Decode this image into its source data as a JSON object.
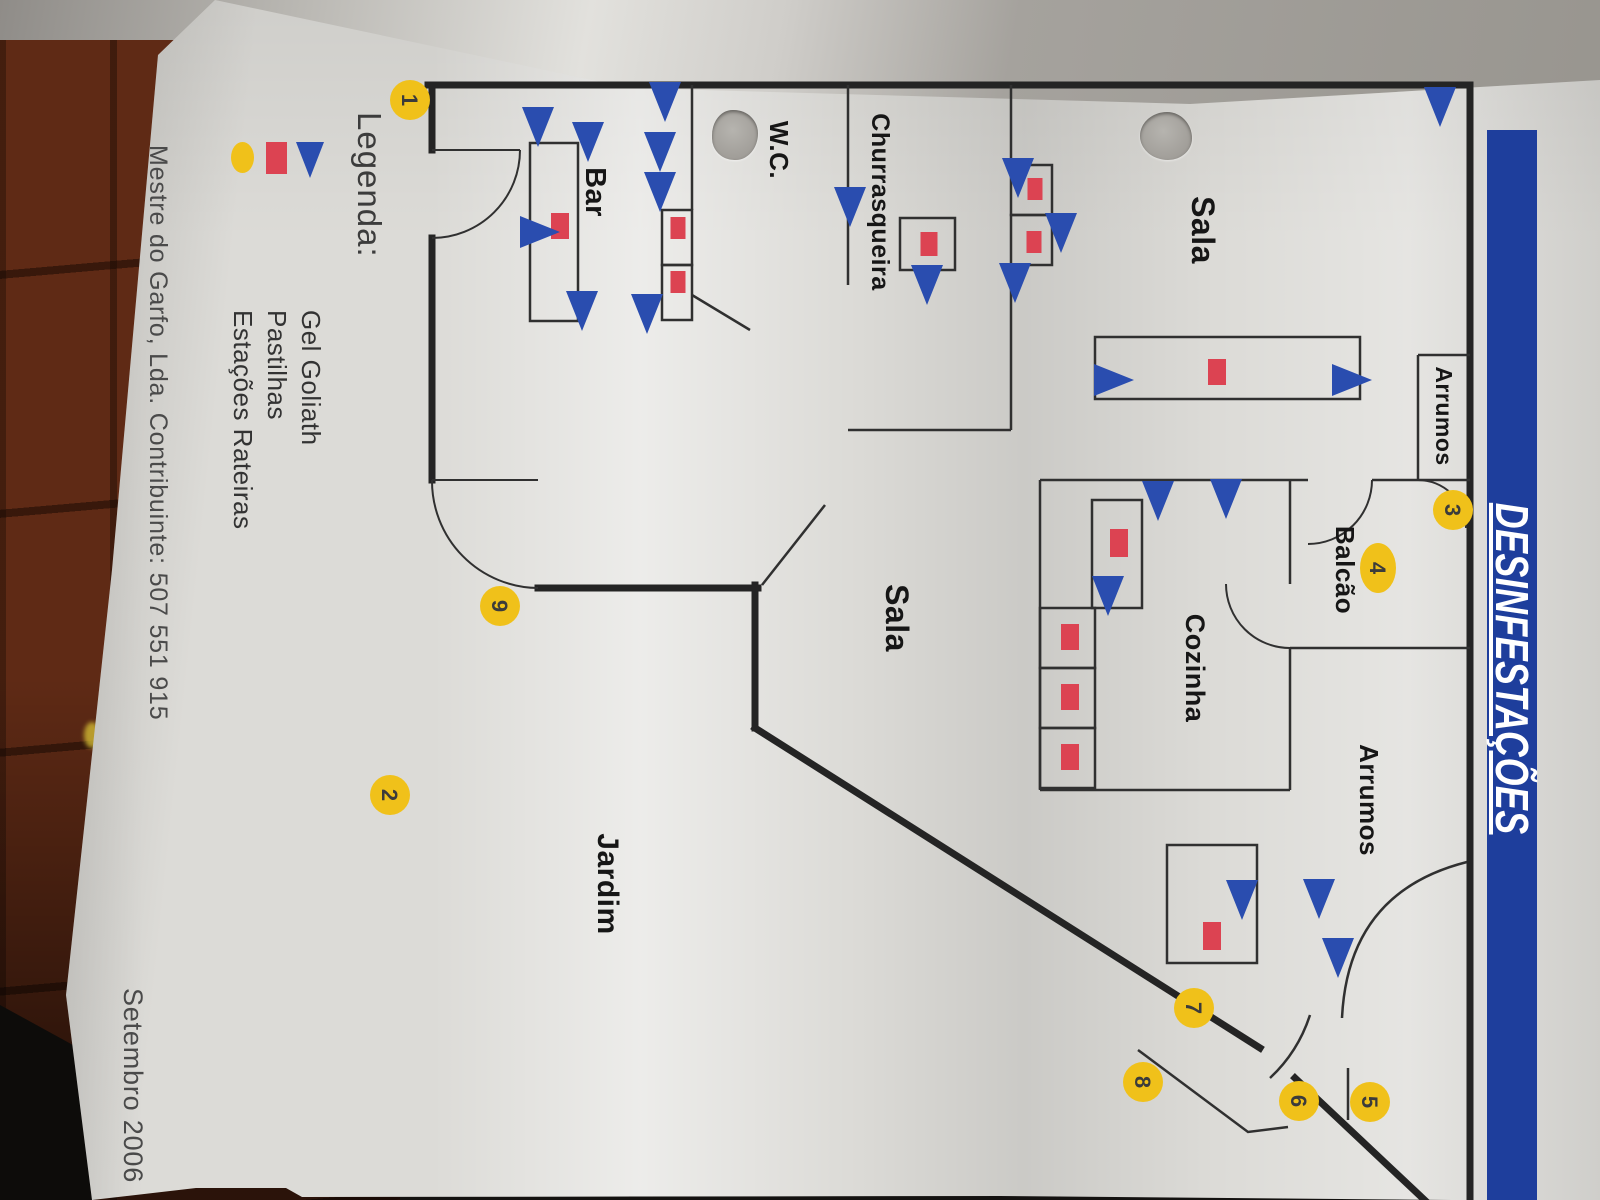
{
  "banner": {
    "title": "DESINFESTAÇÕES"
  },
  "colors": {
    "banner_blue": "#1e3e9c",
    "triangle_blue": "#2a4daf",
    "square_red": "#dc4352",
    "circle_yellow": "#f0c11a",
    "wall_black": "#242424"
  },
  "legend": {
    "heading": "Legenda:",
    "items": [
      {
        "symbol": "triangle-icon",
        "label": "Gel Goliath"
      },
      {
        "symbol": "square-icon",
        "label": "Pastilhas"
      },
      {
        "symbol": "ellipse-icon",
        "label": "Estações Rateiras"
      }
    ]
  },
  "footer": {
    "company": "Mestre do Garfo, Lda. Contribuinte: 507 551 915",
    "date": "Setembro 2006"
  },
  "plan": {
    "rooms": [
      {
        "label": "Sala",
        "x": 230,
        "y": 408,
        "fs": 32
      },
      {
        "label": "Arrumos",
        "x": 416,
        "y": 164,
        "fs": 23
      },
      {
        "label": "Balcão",
        "x": 570,
        "y": 264,
        "fs": 26
      },
      {
        "label": "Cozinha",
        "x": 668,
        "y": 414,
        "fs": 27
      },
      {
        "label": "Arrumos",
        "x": 800,
        "y": 240,
        "fs": 26
      },
      {
        "label": "Sala",
        "x": 618,
        "y": 714,
        "fs": 32
      },
      {
        "label": "Jardim",
        "x": 884,
        "y": 1002,
        "fs": 30
      },
      {
        "label": "Churrasqueira",
        "x": 202,
        "y": 728,
        "fs": 25
      },
      {
        "label": "W.C.",
        "x": 150,
        "y": 830,
        "fs": 26
      },
      {
        "label": "Bar",
        "x": 192,
        "y": 1014,
        "fs": 29
      }
    ],
    "station_circles": [
      {
        "n": "1",
        "x": 100,
        "y": 1190
      },
      {
        "n": "2",
        "x": 795,
        "y": 1210
      },
      {
        "n": "3",
        "x": 510,
        "y": 147
      },
      {
        "n": "4",
        "x": 568,
        "y": 222,
        "rx": 25,
        "ry": 18
      },
      {
        "n": "5",
        "x": 1102,
        "y": 230
      },
      {
        "n": "6",
        "x": 1101,
        "y": 301
      },
      {
        "n": "7",
        "x": 1008,
        "y": 406
      },
      {
        "n": "8",
        "x": 1082,
        "y": 457
      },
      {
        "n": "9",
        "x": 606,
        "y": 1100
      }
    ],
    "gel_triangles": [
      {
        "x": 105,
        "y": 160,
        "dir": "r"
      },
      {
        "x": 497,
        "y": 374,
        "dir": "r"
      },
      {
        "x": 499,
        "y": 442,
        "dir": "r"
      },
      {
        "x": 594,
        "y": 492,
        "dir": "r"
      },
      {
        "x": 380,
        "y": 250,
        "dir": "u"
      },
      {
        "x": 380,
        "y": 488,
        "dir": "u"
      },
      {
        "x": 176,
        "y": 582,
        "dir": "r"
      },
      {
        "x": 231,
        "y": 539,
        "dir": "r"
      },
      {
        "x": 281,
        "y": 585,
        "dir": "r"
      },
      {
        "x": 205,
        "y": 750,
        "dir": "r"
      },
      {
        "x": 283,
        "y": 673,
        "dir": "r"
      },
      {
        "x": 100,
        "y": 935,
        "dir": "r"
      },
      {
        "x": 150,
        "y": 940,
        "dir": "r"
      },
      {
        "x": 190,
        "y": 940,
        "dir": "r"
      },
      {
        "x": 140,
        "y": 1012,
        "dir": "r"
      },
      {
        "x": 125,
        "y": 1062,
        "dir": "r"
      },
      {
        "x": 232,
        "y": 1062,
        "dir": "u"
      },
      {
        "x": 309,
        "y": 1018,
        "dir": "r"
      },
      {
        "x": 312,
        "y": 953,
        "dir": "r"
      },
      {
        "x": 898,
        "y": 358,
        "dir": "r"
      },
      {
        "x": 897,
        "y": 281,
        "dir": "r"
      },
      {
        "x": 956,
        "y": 262,
        "dir": "r"
      }
    ],
    "pastilha_squares": [
      {
        "x": 372,
        "y": 383,
        "w": 26,
        "h": 18
      },
      {
        "x": 189,
        "y": 565,
        "w": 22,
        "h": 15
      },
      {
        "x": 242,
        "y": 566,
        "w": 22,
        "h": 15
      },
      {
        "x": 244,
        "y": 671,
        "w": 24,
        "h": 17
      },
      {
        "x": 228,
        "y": 922,
        "w": 22,
        "h": 15
      },
      {
        "x": 282,
        "y": 922,
        "w": 22,
        "h": 15
      },
      {
        "x": 226,
        "y": 1040,
        "w": 26,
        "h": 18
      },
      {
        "x": 543,
        "y": 481,
        "w": 28,
        "h": 18
      },
      {
        "x": 637,
        "y": 530,
        "w": 26,
        "h": 18
      },
      {
        "x": 697,
        "y": 530,
        "w": 26,
        "h": 18
      },
      {
        "x": 757,
        "y": 530,
        "w": 26,
        "h": 18
      },
      {
        "x": 936,
        "y": 388,
        "w": 28,
        "h": 18
      }
    ]
  }
}
